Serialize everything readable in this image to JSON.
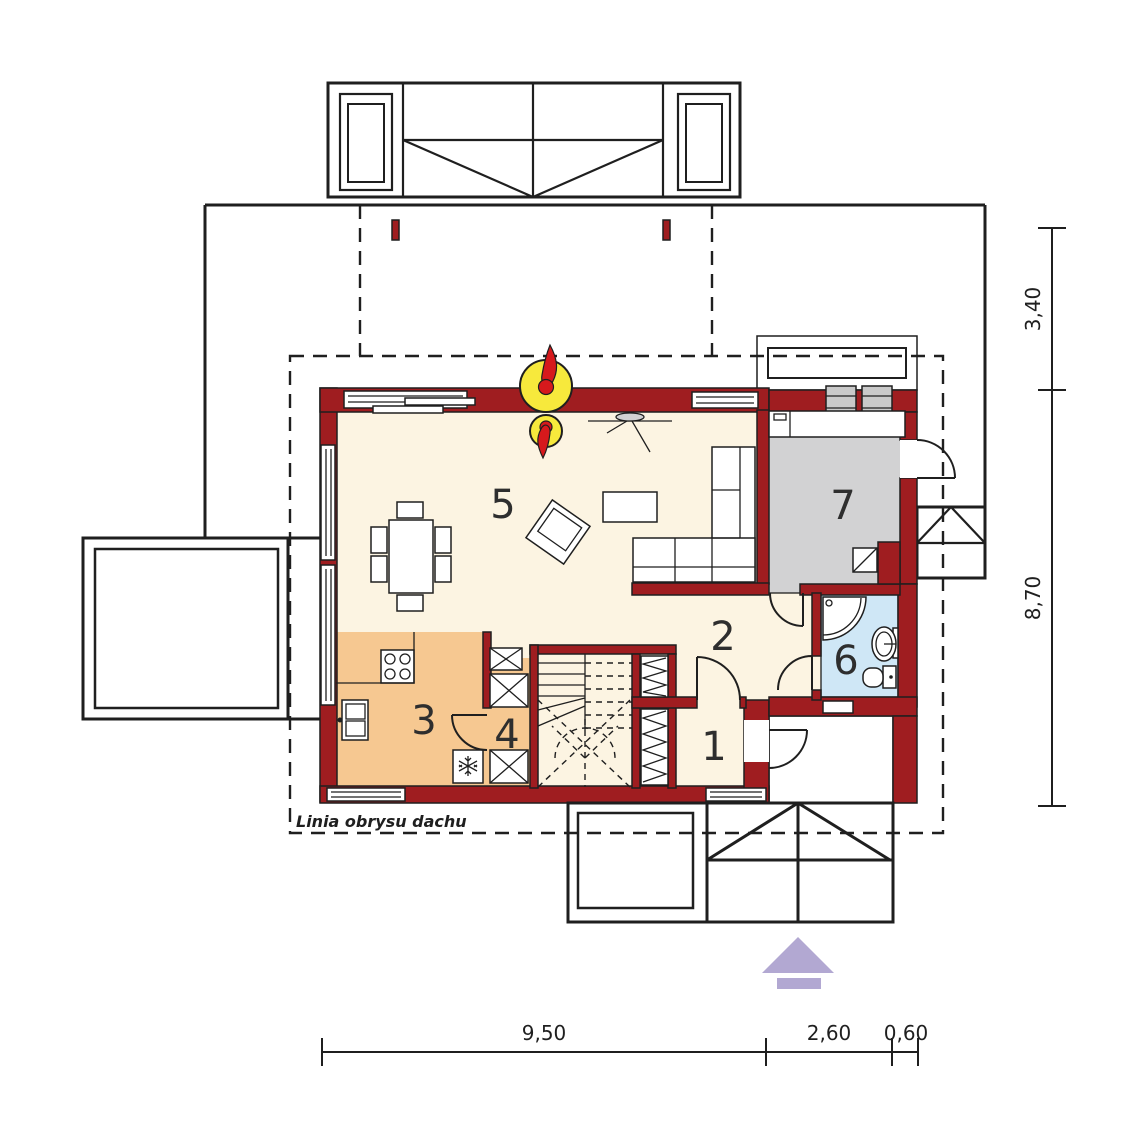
{
  "plan": {
    "roof_outline_label": "Linia obrysu dachu",
    "room_numbers": {
      "r1": "1",
      "r2": "2",
      "r3": "3",
      "r4": "4",
      "r5": "5",
      "r6": "6",
      "r7": "7"
    },
    "dimensions": {
      "bottom": [
        {
          "value": "9,50"
        },
        {
          "value": "2,60"
        },
        {
          "value": "0,60"
        }
      ],
      "right": [
        {
          "value": "3,40"
        },
        {
          "value": "8,70"
        }
      ]
    }
  },
  "colors": {
    "wall": "#9f1d20",
    "line": "#1f1f1f",
    "floor": "#fcf4e2",
    "kitchen": "#f6c891",
    "utility": "#d2d2d3",
    "bath": "#cfe7f6",
    "window_frame": "#c9c9c9",
    "chimney_yellow": "#f7e93c",
    "flame_red": "#d6191c",
    "north_arrow": "#b2a8d2"
  }
}
